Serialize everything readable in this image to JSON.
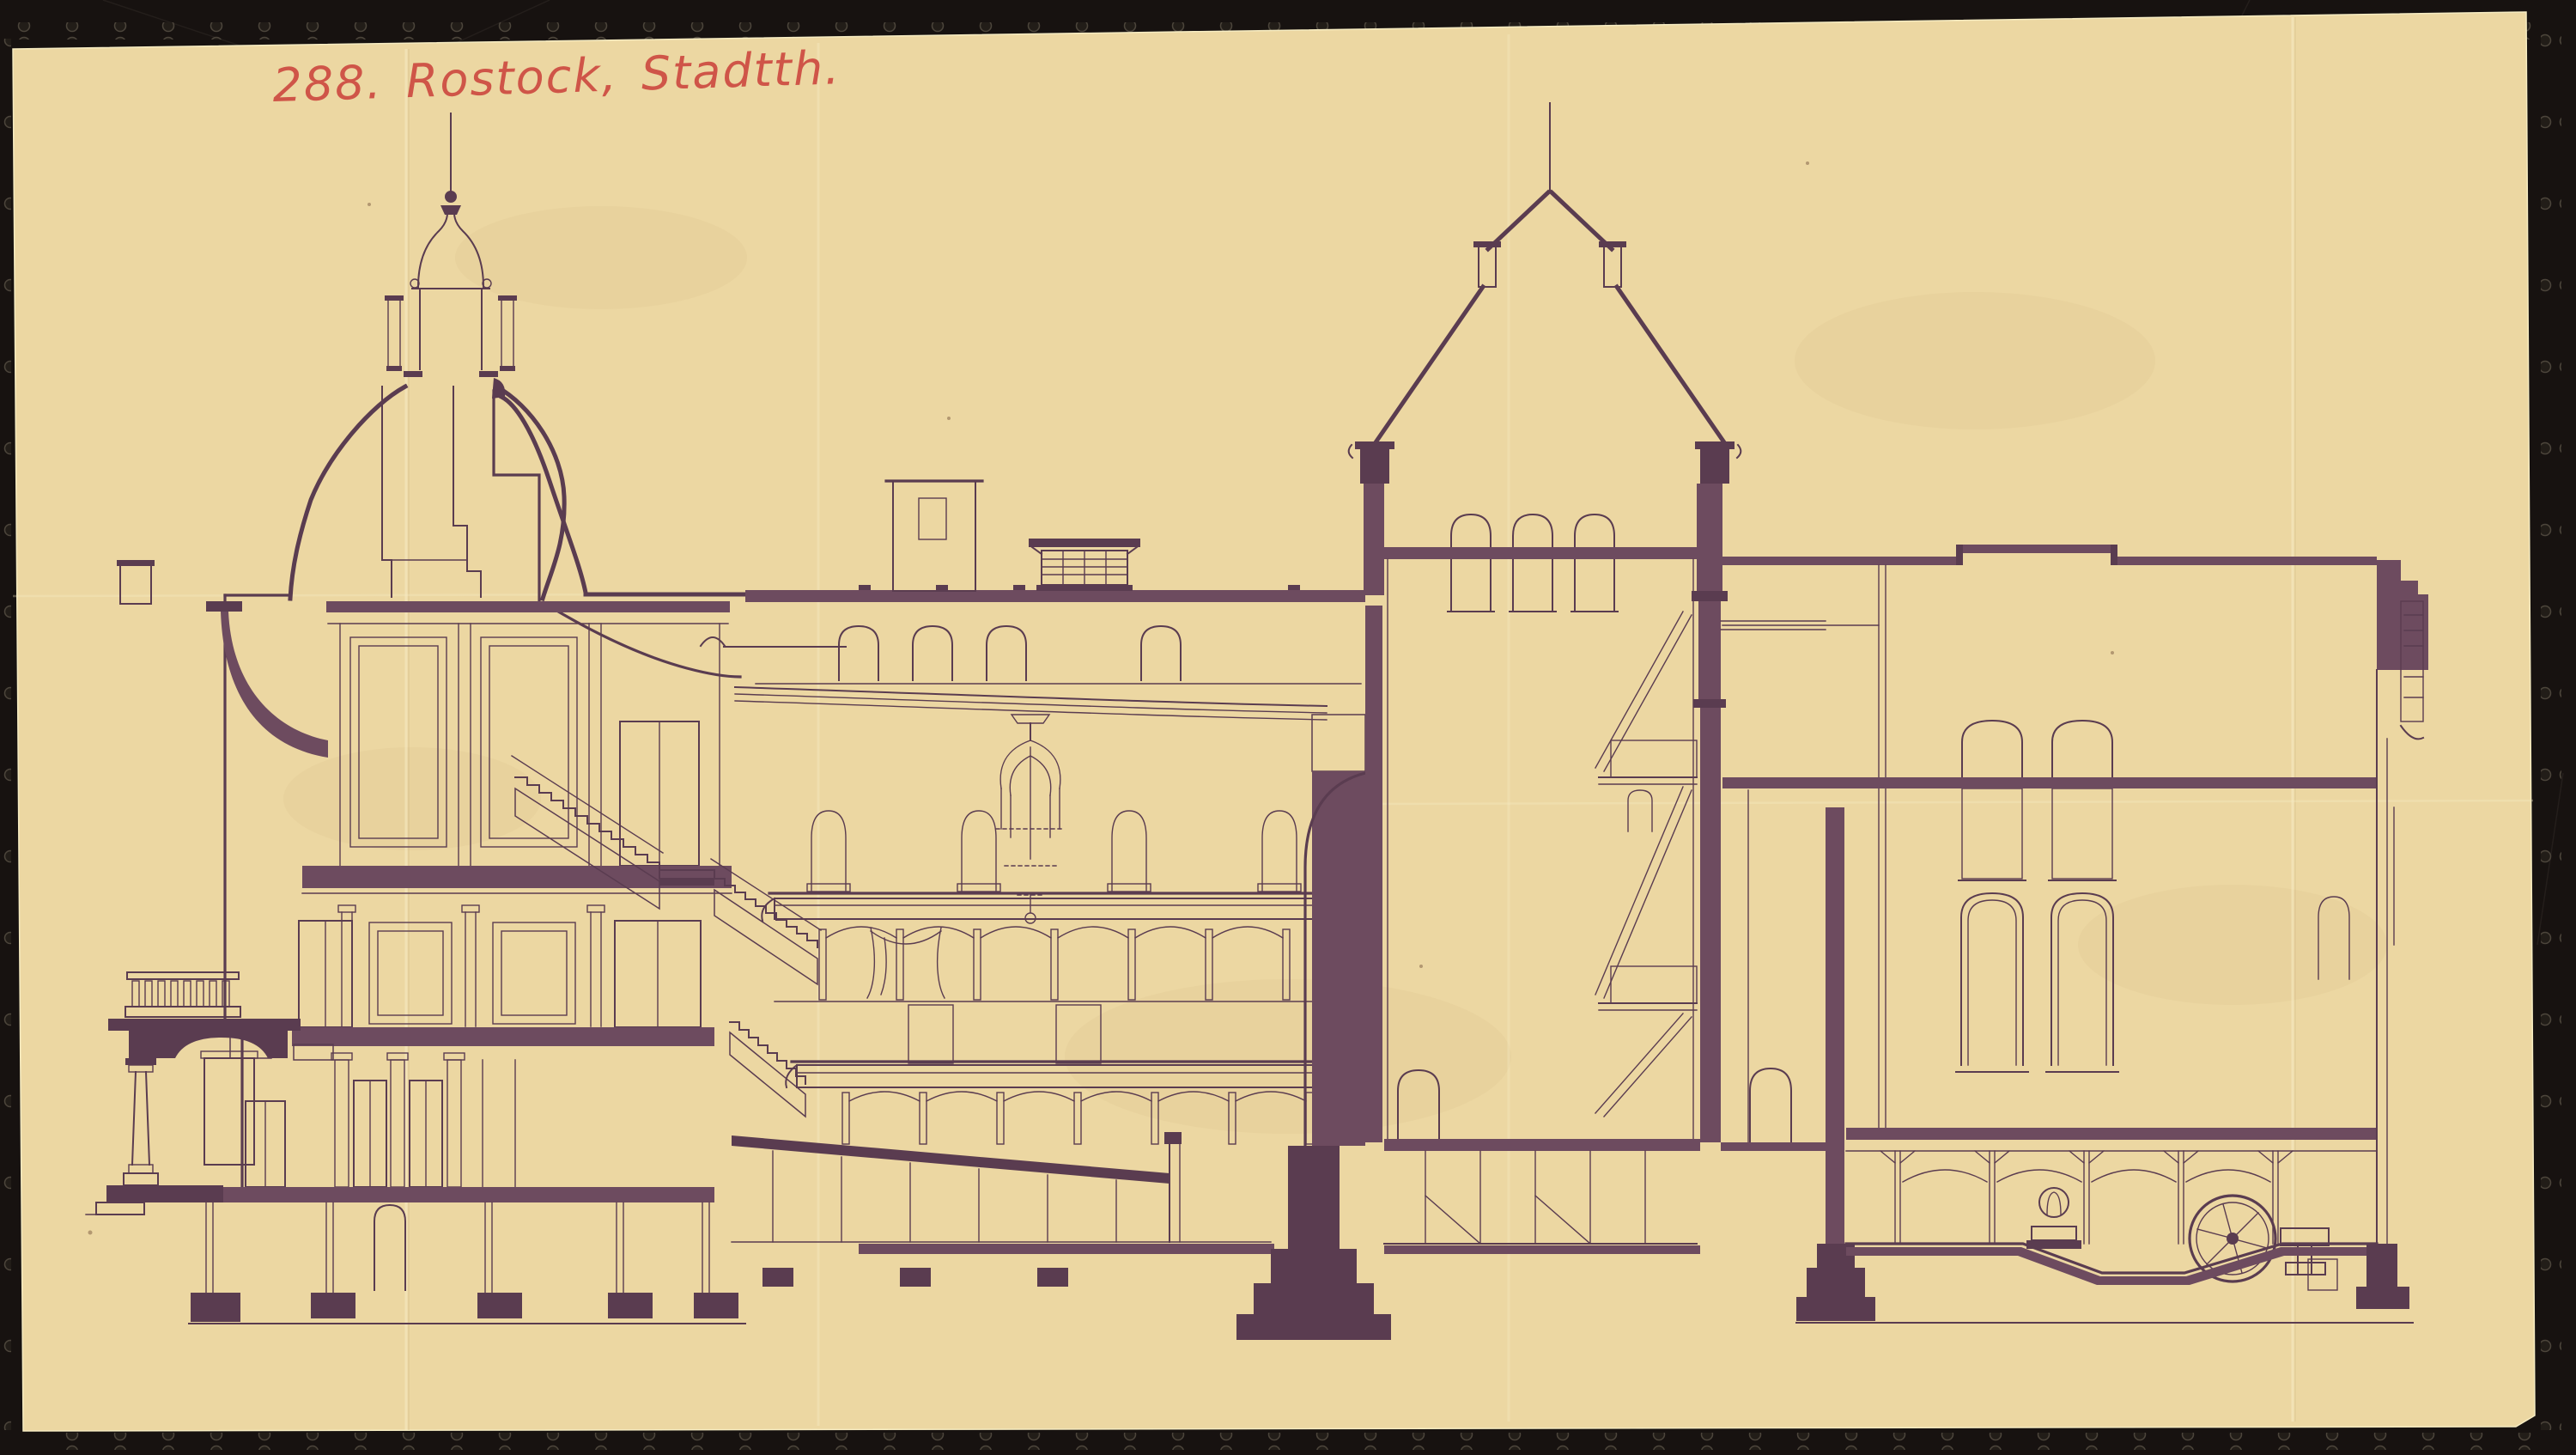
{
  "annotation": {
    "text": "288. Rostock, Stadtth."
  },
  "colors": {
    "film": "#171210",
    "paper": "#ecd7a2",
    "ink": "#5a3c50",
    "poche": "#6d4b5f",
    "red_crayon": "#cd4a41",
    "crease": "#f8eec8"
  }
}
